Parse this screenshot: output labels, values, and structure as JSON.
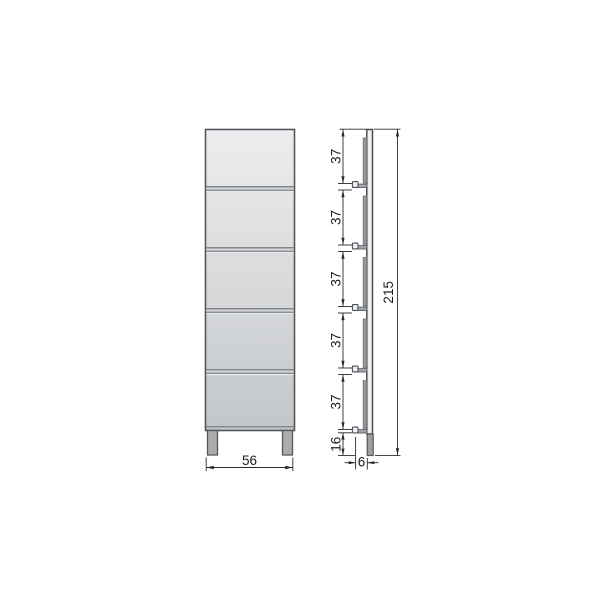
{
  "colors": {
    "background": "#ffffff",
    "outline": "#54585c",
    "dimension_line": "#2b2b2b",
    "label_text": "#1d1d1f",
    "body_gradient_top": "#ebedef",
    "body_gradient_bottom": "#c3c6c9",
    "divider_dark": "#83878b",
    "divider_light": "#d6d8da",
    "leg_fill": "#aaadb0",
    "foot_fill": "#9aa0a4",
    "rail_fill": "#96999d",
    "shelf_bar_fill": "#a3a7ab",
    "panel_gap_fill": "#eff0f1"
  },
  "front_view": {
    "width_label": "56"
  },
  "side_view": {
    "segment_labels": [
      "37",
      "37",
      "37",
      "37",
      "37"
    ],
    "plinth_label": "16",
    "total_height_label": "215",
    "depth_label": "6"
  }
}
